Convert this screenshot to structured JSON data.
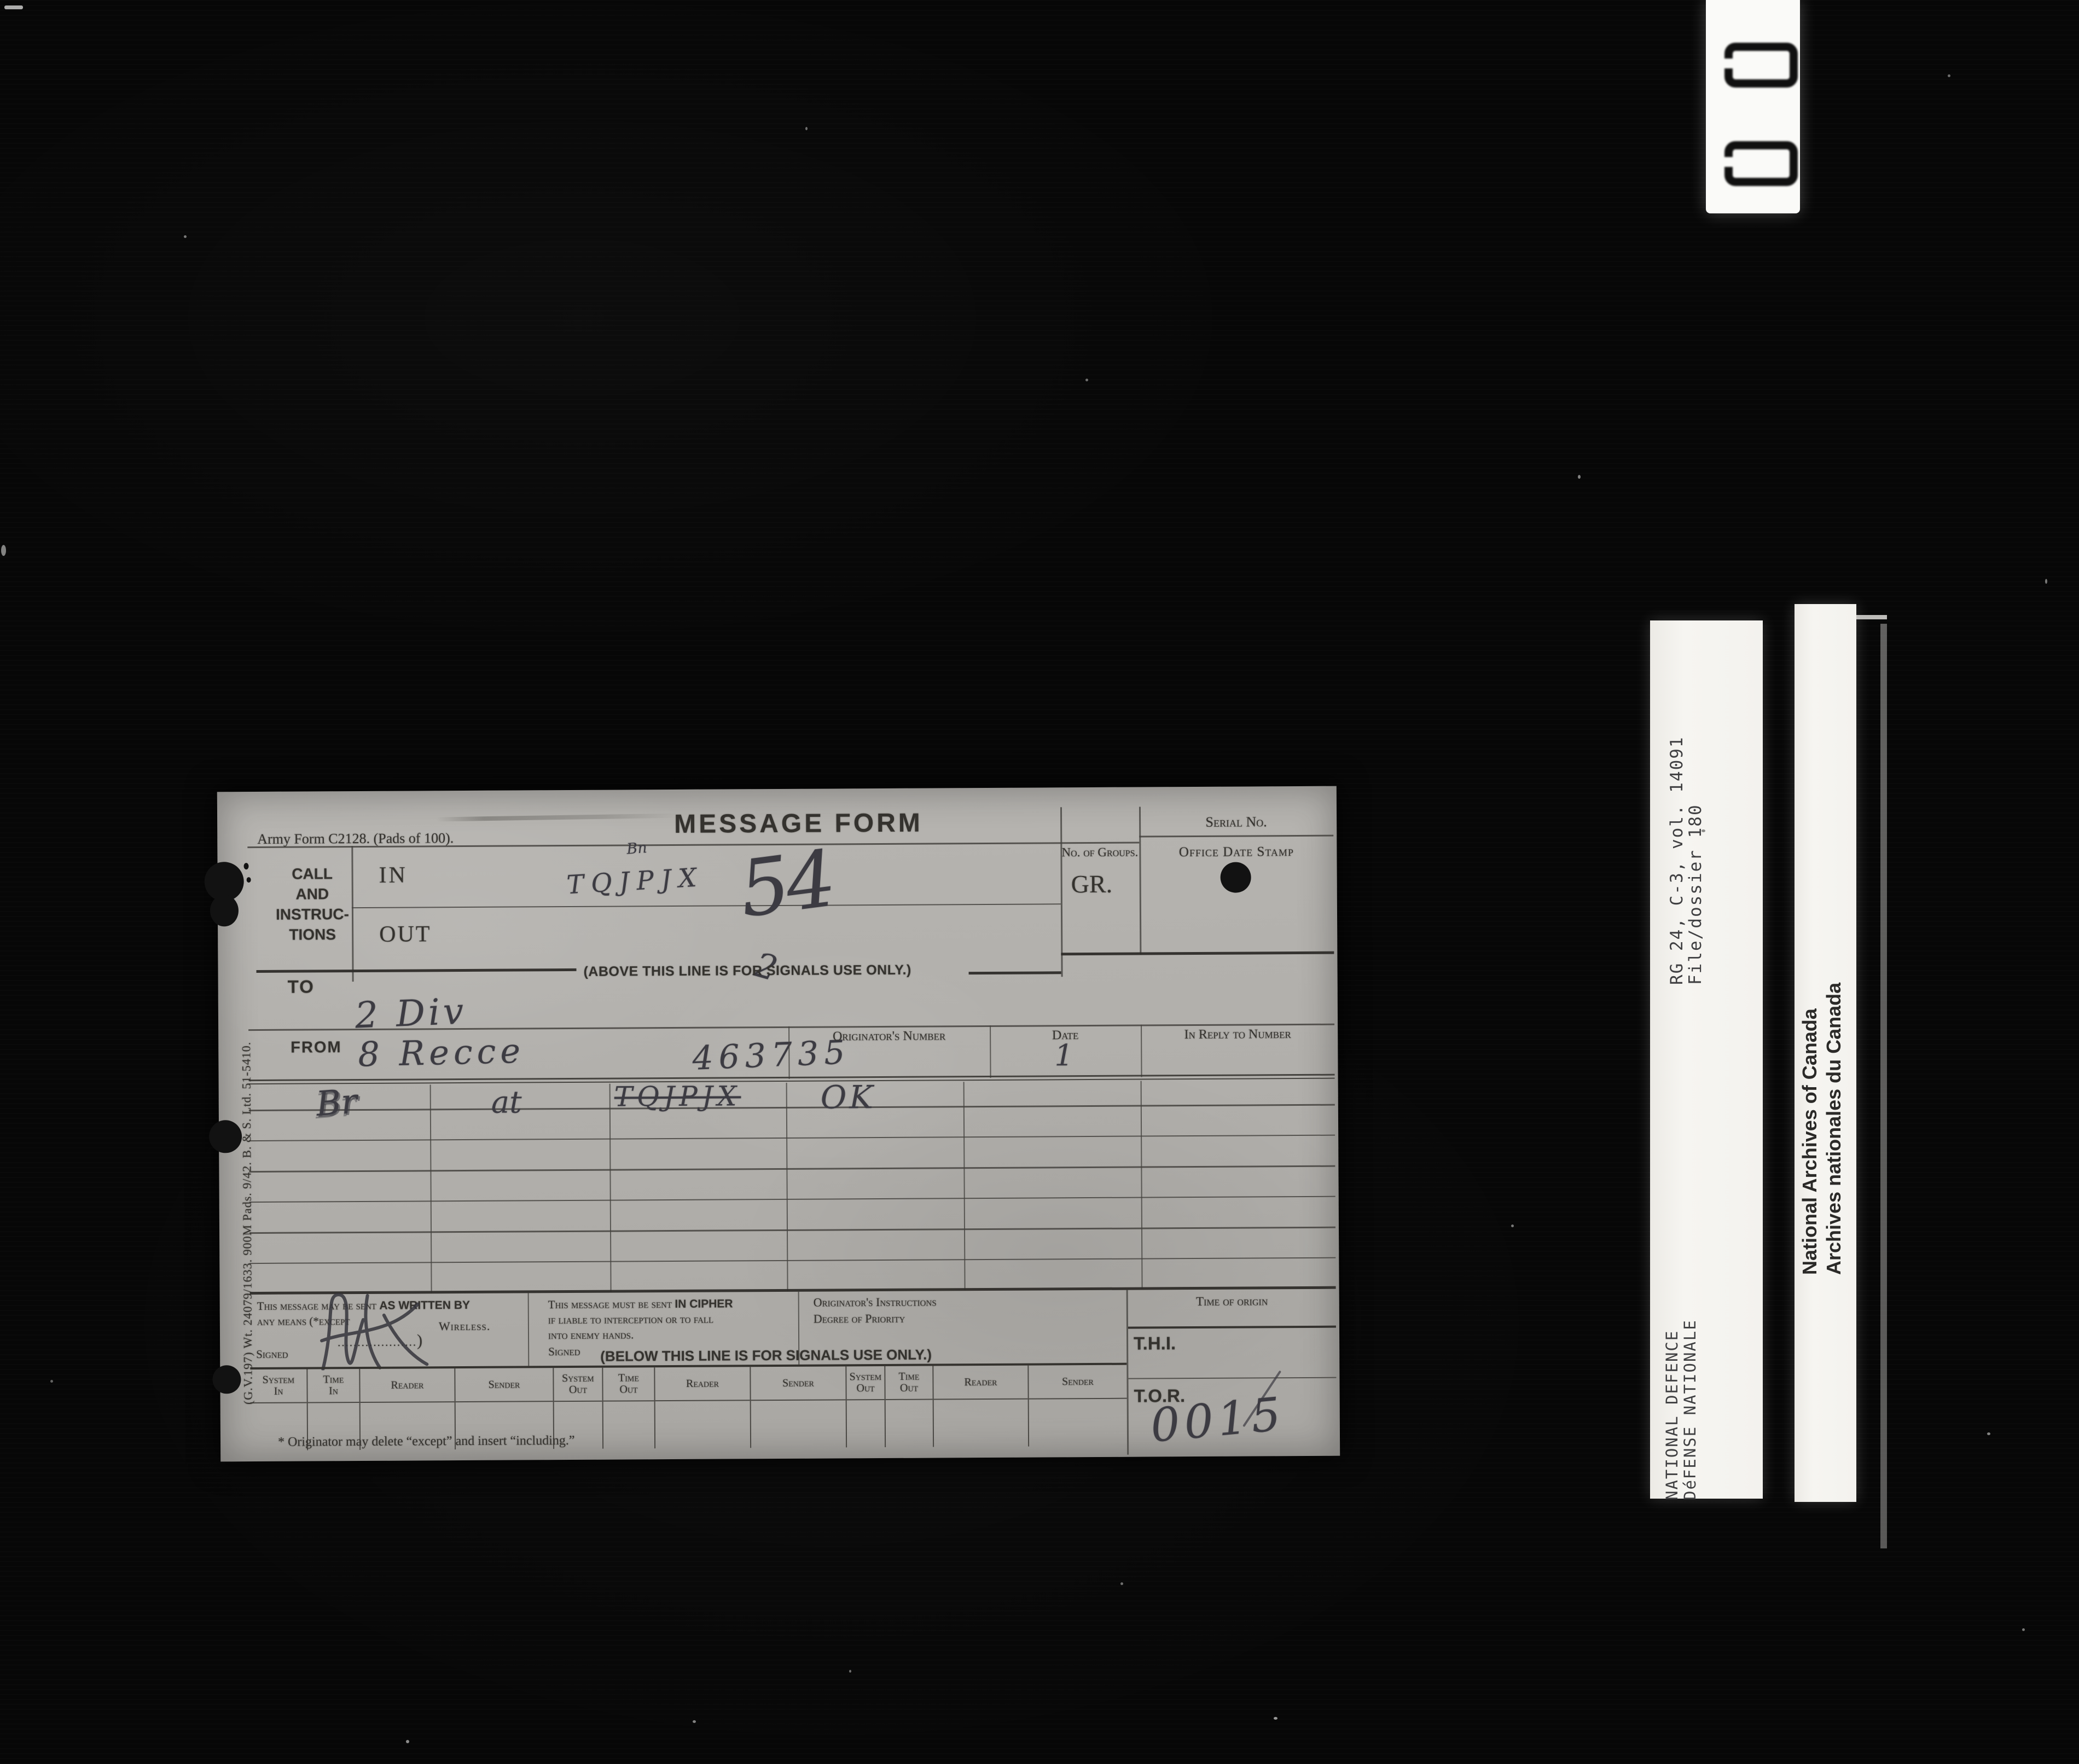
{
  "colors": {
    "film_background": "#070707",
    "paper": "#b2b0ac",
    "ink": "#34322e",
    "pencil": "#3c3b42",
    "strip_white": "#f4f3ef"
  },
  "film": {
    "frame_counter": "00"
  },
  "strips": {
    "reference": {
      "line1": "RG 24, C-3, vol. 14091",
      "line2": "File/dossier 180"
    },
    "department": {
      "line1": "NATIONAL DEFENCE",
      "line2": "DéFENSE NATIONALE"
    },
    "archives": {
      "line1": "National Archives of Canada",
      "line2": "Archives nationales du Canada"
    }
  },
  "form": {
    "form_number": "Army Form C2128.  (Pads of 100).",
    "title": "MESSAGE FORM",
    "serial_label": "Serial No.",
    "groups_label": "No. of Groups.",
    "gr_label": "GR.",
    "date_stamp_label": "Office Date Stamp",
    "call_line1": "CALL",
    "call_line2": "AND",
    "call_line3": "INSTRUC-",
    "call_line4": "TIONS",
    "in_label": "IN",
    "out_label": "OUT",
    "above_note": "(ABOVE THIS LINE IS FOR SIGNALS USE ONLY.)",
    "to_label": "TO",
    "from_label": "FROM",
    "originators_number_label": "Originator's Number",
    "date_label": "Date",
    "in_reply_label": "In Reply to Number",
    "written_note": {
      "pre": "This message may be sent ",
      "bold": "AS WRITTEN BY",
      "line2": "any means (*except",
      "leader": "....................",
      "bracket": ")",
      "wireless": "Wireless.",
      "signed": "Signed"
    },
    "cipher_note": {
      "pre": "This message must be sent ",
      "bold": "IN CIPHER",
      "line2": "if liable to interception or to fall",
      "line3": "into enemy hands.",
      "signed": "Signed"
    },
    "below_note": "(BELOW THIS LINE IS FOR SIGNALS USE ONLY.)",
    "originator_instructions_line1": "Originator's Instructions",
    "originator_instructions_line2": "Degree of Priority",
    "time_of_origin_label": "Time of origin",
    "thi_label": "T.H.I.",
    "tor_label": "T.O.R.",
    "signal_columns": [
      {
        "l1": "System",
        "l2": "In"
      },
      {
        "l1": "Time",
        "l2": "In"
      },
      {
        "l1": "Reader"
      },
      {
        "l1": "Sender"
      },
      {
        "l1": "System",
        "l2": "Out"
      },
      {
        "l1": "Time",
        "l2": "Out"
      },
      {
        "l1": "Reader"
      },
      {
        "l1": "Sender"
      },
      {
        "l1": "System",
        "l2": "Out"
      },
      {
        "l1": "Time",
        "l2": "Out"
      },
      {
        "l1": "Reader"
      },
      {
        "l1": "Sender"
      }
    ],
    "footnote": "* Originator may delete “except” and insert “including.”",
    "print_code": "(G.V.197)  Wt. 24079/1633.  900M Pads.  9/42.  B. & S. Ltd.  51-5410.",
    "handwriting": {
      "station_note": "Bn",
      "call_in": "TQJPJX",
      "group_count": "54",
      "tick": "2",
      "to": "2 Div",
      "from_unit": "8 Recce",
      "from_number": "463735",
      "date": "1",
      "msg_col1": "Br",
      "msg_col2": "at",
      "msg_col3": "TQJPJX",
      "msg_col4": "OK",
      "tor": "0015"
    }
  }
}
